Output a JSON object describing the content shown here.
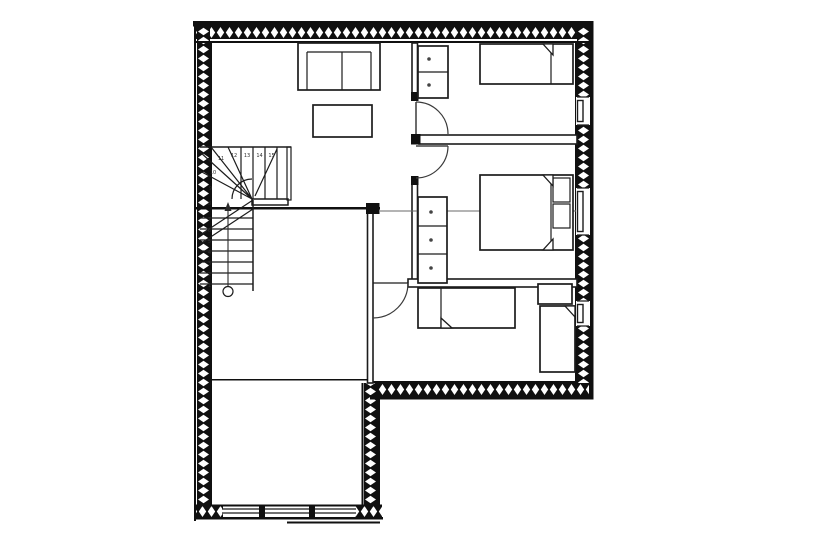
{
  "title": "floor-plan",
  "colors": {
    "bg": "#ffffff",
    "line": "#1c1c1c",
    "wall": "#101010",
    "door": "#3a3a3a",
    "section": "#6a6a6a",
    "text": "#2f2f2f"
  },
  "stairs": {
    "type": "winder-staircase",
    "steps": [
      "1",
      "2",
      "3",
      "4",
      "5",
      "6",
      "7",
      "8",
      "9",
      "10",
      "11",
      "12",
      "13",
      "14",
      "15"
    ]
  },
  "legend": {
    "furniture_icons": [
      "sofa",
      "coffee-table",
      "single-bed",
      "double-bed",
      "pillow",
      "wardrobe",
      "cabinet",
      "shelf"
    ],
    "features": [
      "hatched-exterior-walls",
      "door-swing-arcs",
      "windows",
      "section-line",
      "stair-walkline"
    ]
  }
}
